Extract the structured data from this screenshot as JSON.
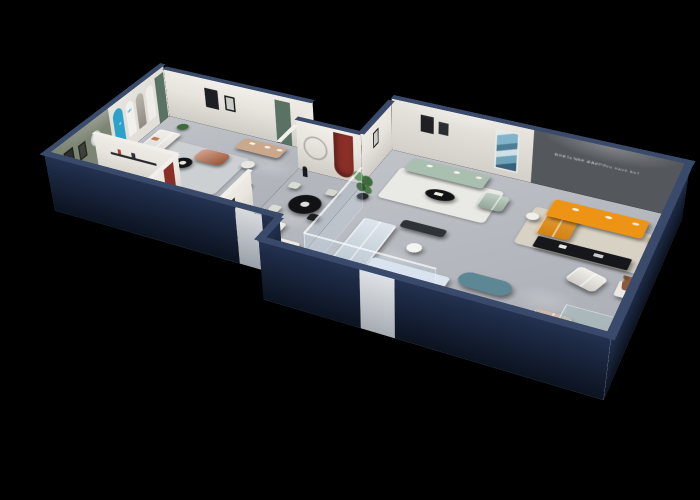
{
  "scene": {
    "title": "isometric-showroom-cutaway-render",
    "background": "#000000",
    "rooms": [
      "west-display-room",
      "bedroom",
      "lounge-corner",
      "corridor-dining",
      "sage-sofa-room",
      "glass-sofa-gallery",
      "orange-lounge",
      "south-gallery"
    ]
  },
  "palette": {
    "background": "#000000",
    "navy_face": "#17213a",
    "navy_cap": "#3a4a6b",
    "floor": "#b7bac0",
    "wall_white": "#e6e3dd",
    "wall_olive": "#7c8473",
    "wall_dark": "#54575c",
    "door_green": "#5a7263",
    "poster_blue": "#2ba2c9",
    "arch_red": "#8a2f28",
    "sofa_white": "#edeae3",
    "sofa_sage": "#a9bfb0",
    "sofa_orange": "#ee9414",
    "sofa_terracotta": "#c0664a",
    "sofa_paleblue": "#d4dee8",
    "loveseat_beige": "#c9a88c",
    "chair_caramel": "#b5714a",
    "armchair_beige": "#c4a38e",
    "bench_teal": "#5d8795",
    "wood_copper": "#b2613c",
    "throw_orange": "#c17a52",
    "table_black": "#101214",
    "credenza_black": "#15171a",
    "plant_green": "#3e6b3c",
    "rug_cream": "#d8d2c4",
    "rug_gray": "#ccd0d3",
    "rug_white": "#e9e9e5",
    "rug_dark": "#27292c",
    "bear_brown": "#8a5a3b",
    "door_leaf": "#cbced3"
  },
  "texts": {
    "slogan_line1": "LIFE IS NOT WHAT YOU HAVE BUT",
    "slogan_line2": "WHAT YOU ENJOY",
    "poster_number": "666",
    "sign_letters": "N",
    "blue_poster_glyph": "✻"
  }
}
